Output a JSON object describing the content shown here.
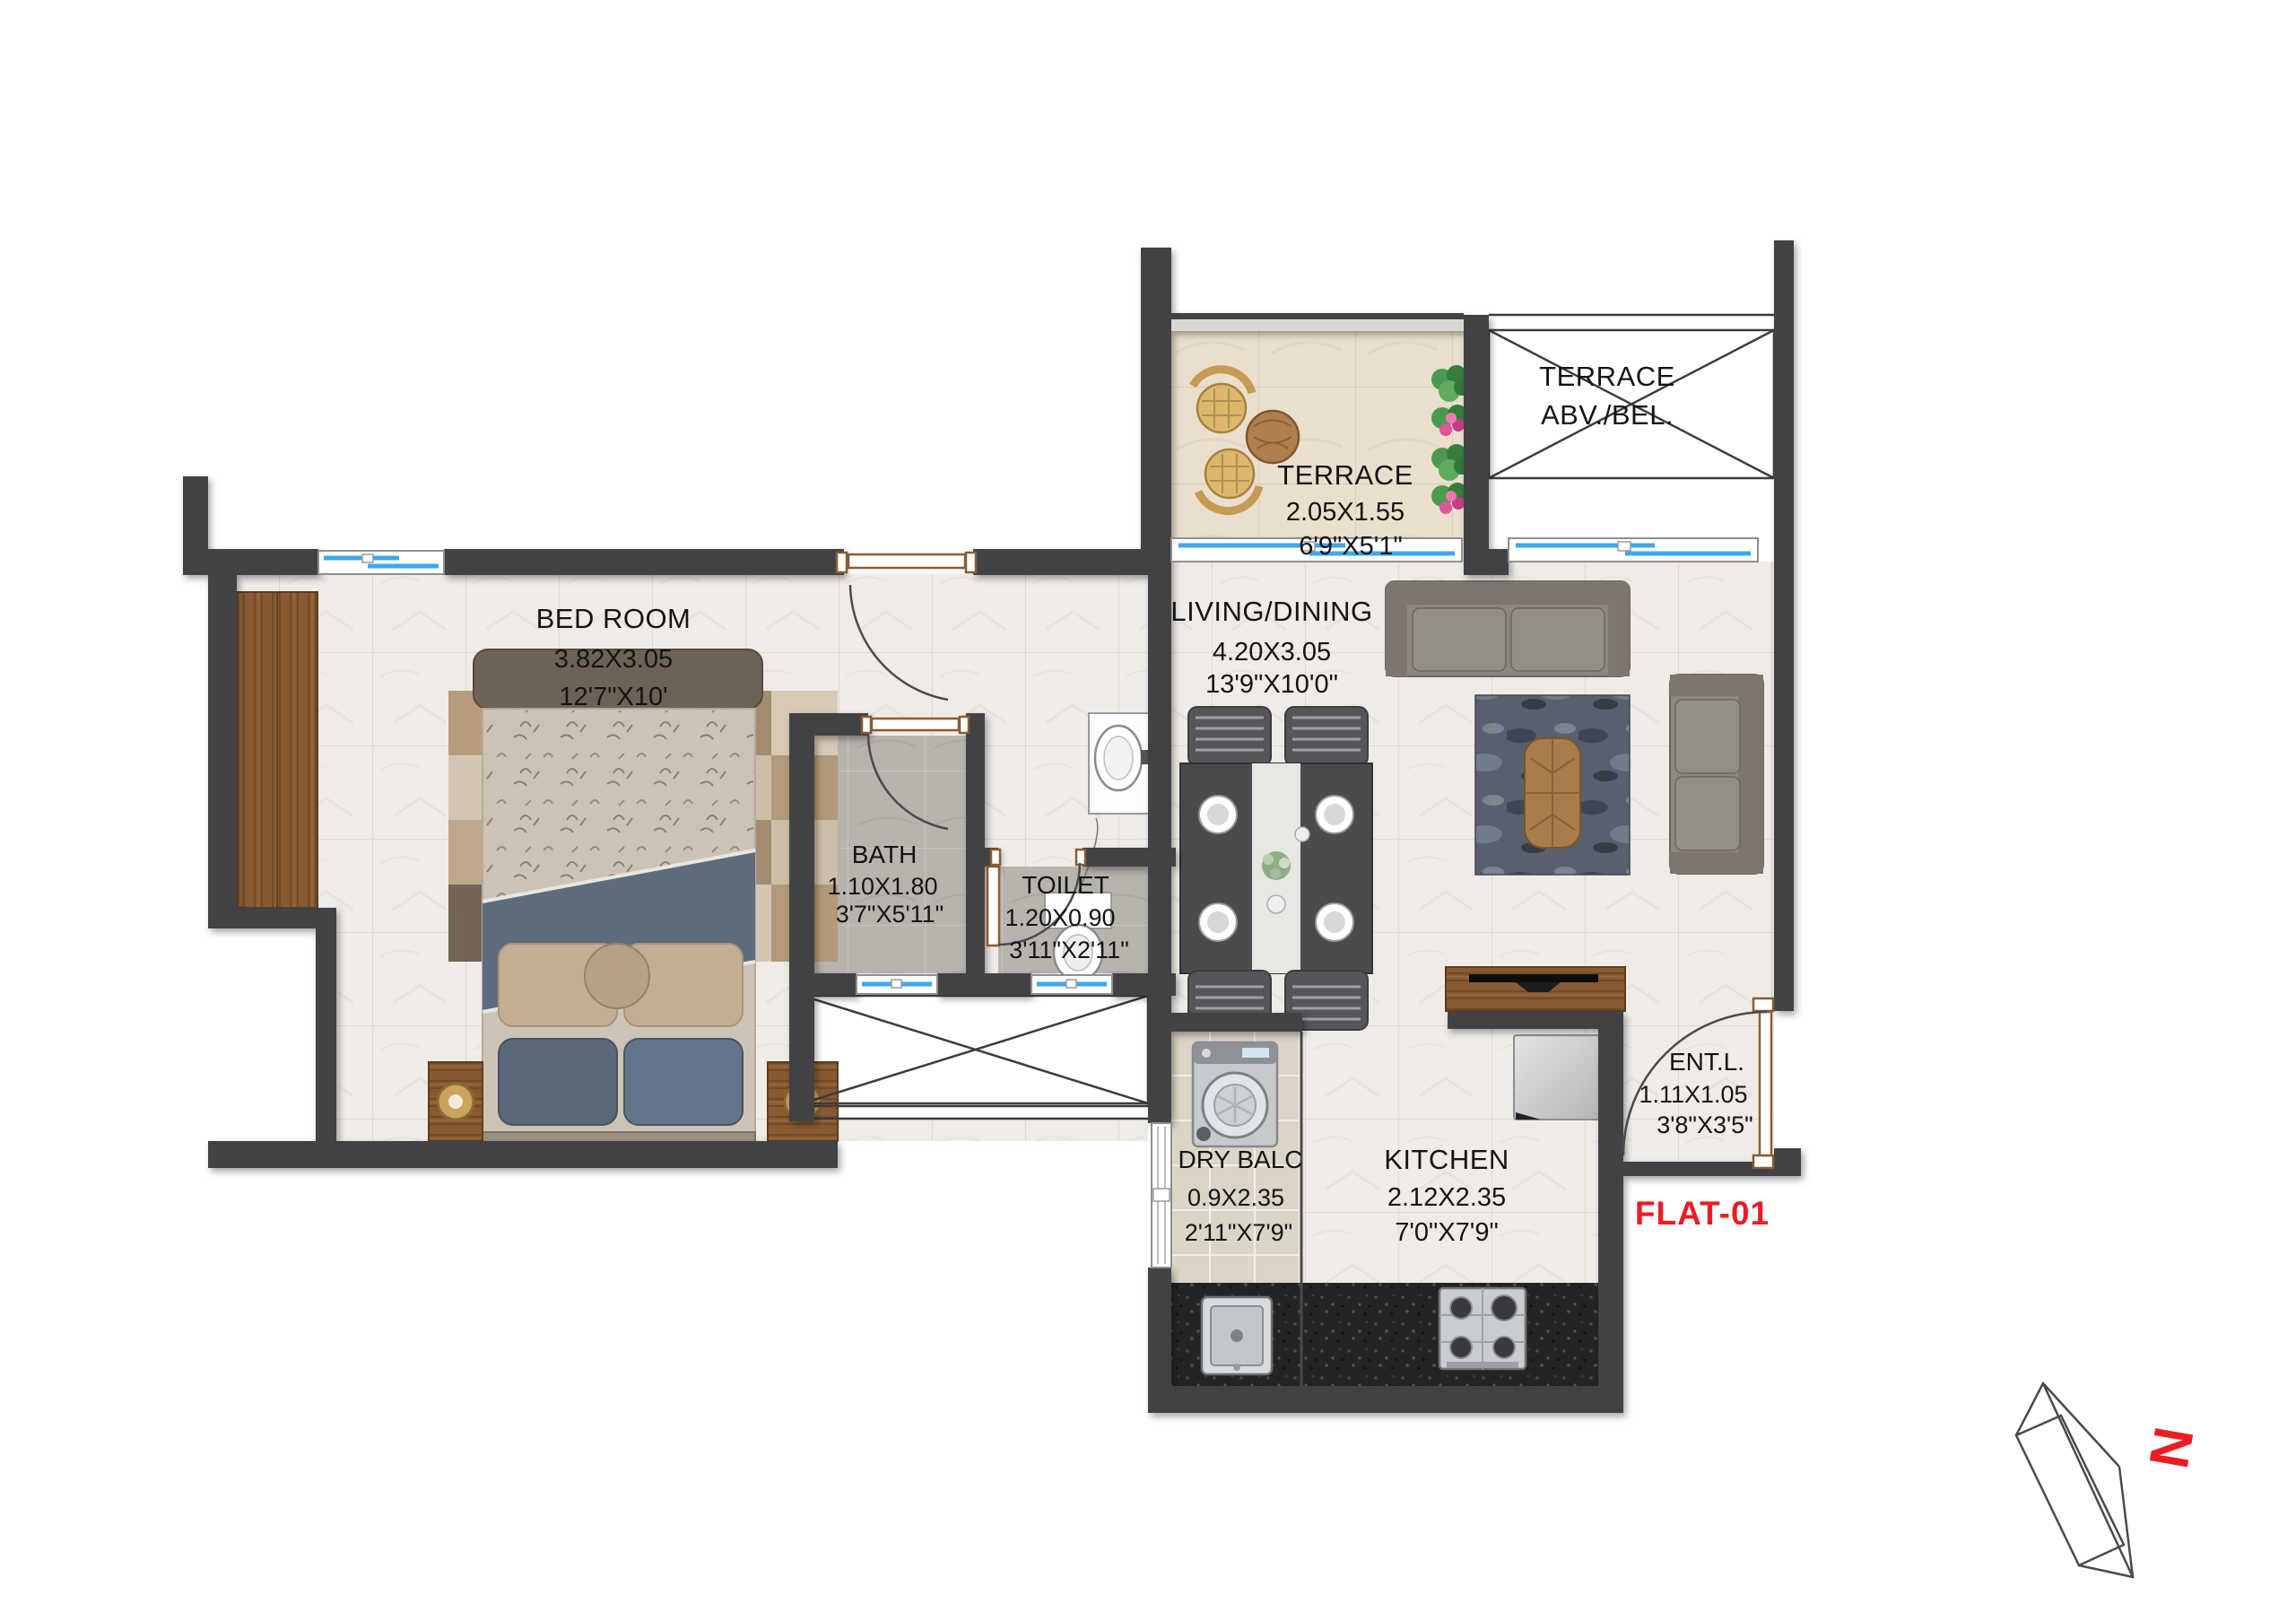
{
  "plan": {
    "flat_label": "FLAT-01",
    "north_label": "N",
    "rooms": {
      "bedroom": {
        "name": "BED ROOM",
        "dim_m": "3.82X3.05",
        "dim_ft": "12'7\"X10'"
      },
      "terrace": {
        "name": "TERRACE",
        "dim_m": "2.05X1.55",
        "dim_ft": "6'9\"X5'1\""
      },
      "terrace_abv": {
        "name": "TERRACE",
        "name_line2": "ABV./BEL."
      },
      "living": {
        "name": "LIVING/DINING",
        "dim_m": "4.20X3.05",
        "dim_ft": "13'9\"X10'0\""
      },
      "bath": {
        "name": "BATH",
        "dim_m": "1.10X1.80",
        "dim_ft": "3'7\"X5'11\""
      },
      "toilet": {
        "name": "TOILET",
        "dim_m": "1.20X0.90",
        "dim_ft": "3'11\"X2'11\""
      },
      "dry_balcony": {
        "name": "DRY BALC",
        "dim_m": "0.9X2.35",
        "dim_ft": "2'11\"X7'9\""
      },
      "kitchen": {
        "name": "KITCHEN",
        "dim_m": "2.12X2.35",
        "dim_ft": "7'0\"X7'9\""
      },
      "entrance_lobby": {
        "name": "ENT.L.",
        "dim_m": "1.11X1.05",
        "dim_ft": "3'8\"X3'5\""
      }
    },
    "colors": {
      "wall": "#424244",
      "window_glass": "#3fa7ef",
      "flat_label": "#ec1c24",
      "wood": "#875a33",
      "granite": "#262626",
      "terrace_tile": "#eadfcd"
    }
  }
}
